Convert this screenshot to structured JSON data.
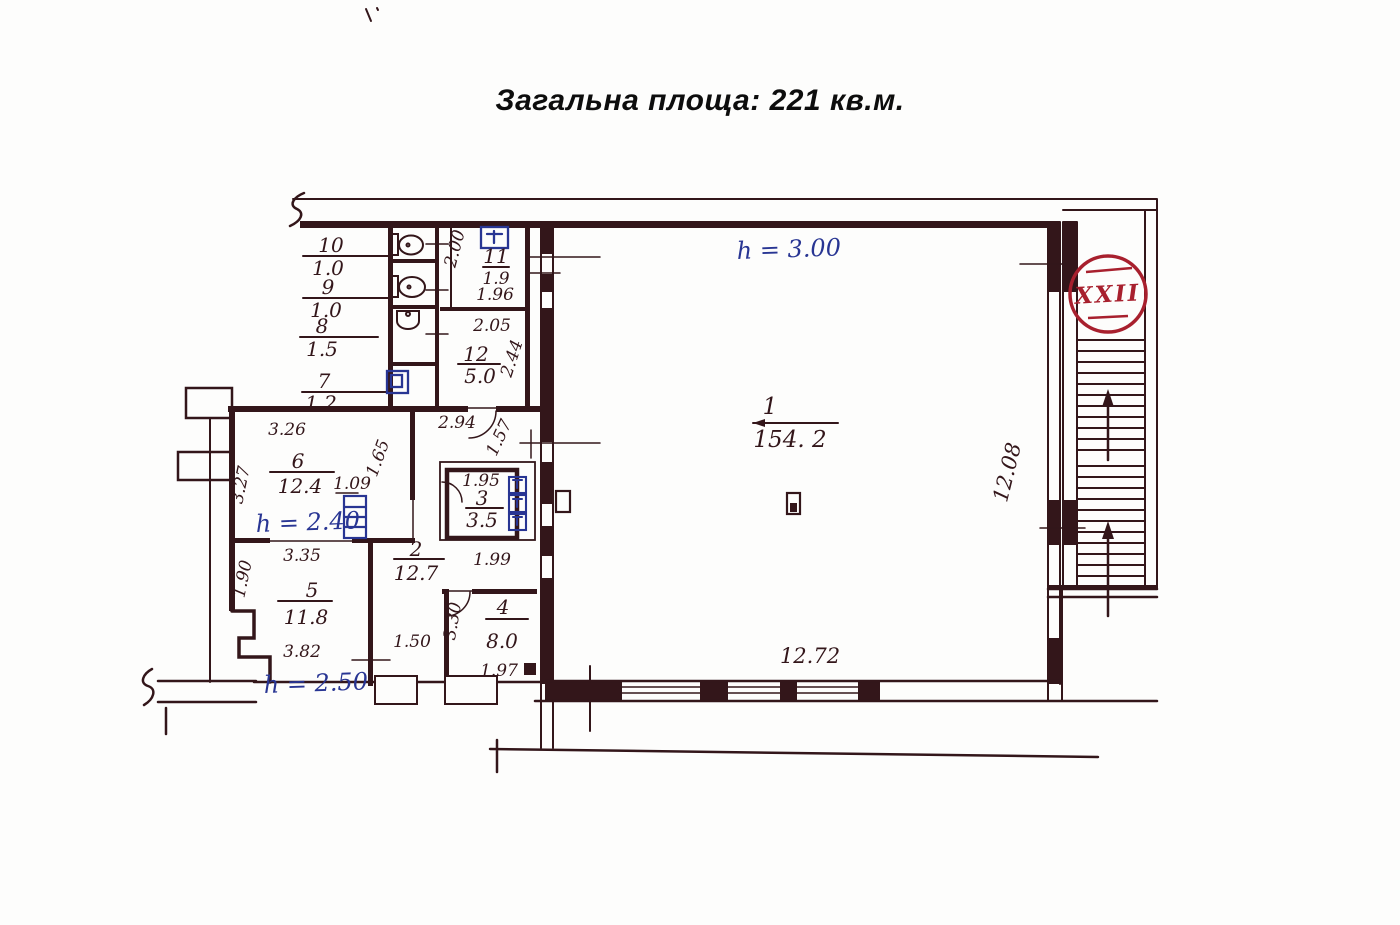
{
  "title": "Загальна площа: 221 кв.м.",
  "stair_badge": "XXII",
  "colors": {
    "ink": "#33161a",
    "blue": "#283593",
    "red": "#a8202e",
    "paper": "#fdfdfc"
  },
  "heights": {
    "hall": "h = 3.00",
    "room6": "h = 2.40",
    "room5": "h = 2.50"
  },
  "rooms": {
    "r1": {
      "number": "1",
      "area": "154. 2"
    },
    "r2": {
      "number": "2",
      "area": "12.7"
    },
    "r3": {
      "number": "3",
      "area": "3.5"
    },
    "r4": {
      "number": "4",
      "area": "8.0"
    },
    "r5": {
      "number": "5",
      "area": "11.8"
    },
    "r6": {
      "number": "6",
      "area": "12.4"
    },
    "r7": {
      "number": "7",
      "area": "1.2"
    },
    "r8": {
      "number": "8",
      "area": "1.5"
    },
    "r9": {
      "number": "9",
      "area": "1.0"
    },
    "r10": {
      "number": "10",
      "area": "1.0"
    },
    "r11": {
      "number": "11",
      "area": "1.9"
    },
    "r12": {
      "number": "12",
      "area": "5.0"
    }
  },
  "dims": {
    "hall_width": "12.72",
    "hall_depth": "12.08",
    "corridor_top": "2.94",
    "corridor_diag": "1.57",
    "room6_top": "3.26",
    "room6_left": "3.27",
    "room6_door": "1.09",
    "room6_right": "1.65",
    "room5_top": "3.35",
    "room5_left": "1.90",
    "room5_bottom": "3.82",
    "room11_left": "2.00",
    "room11_width": "1.96",
    "room12_top": "2.05",
    "room12_right": "2.44",
    "room3_top": "1.95",
    "room3_door": "1.99",
    "corridor_bottom": "1.50",
    "room4_left": "3.30",
    "room4_bottom": "1.97"
  }
}
